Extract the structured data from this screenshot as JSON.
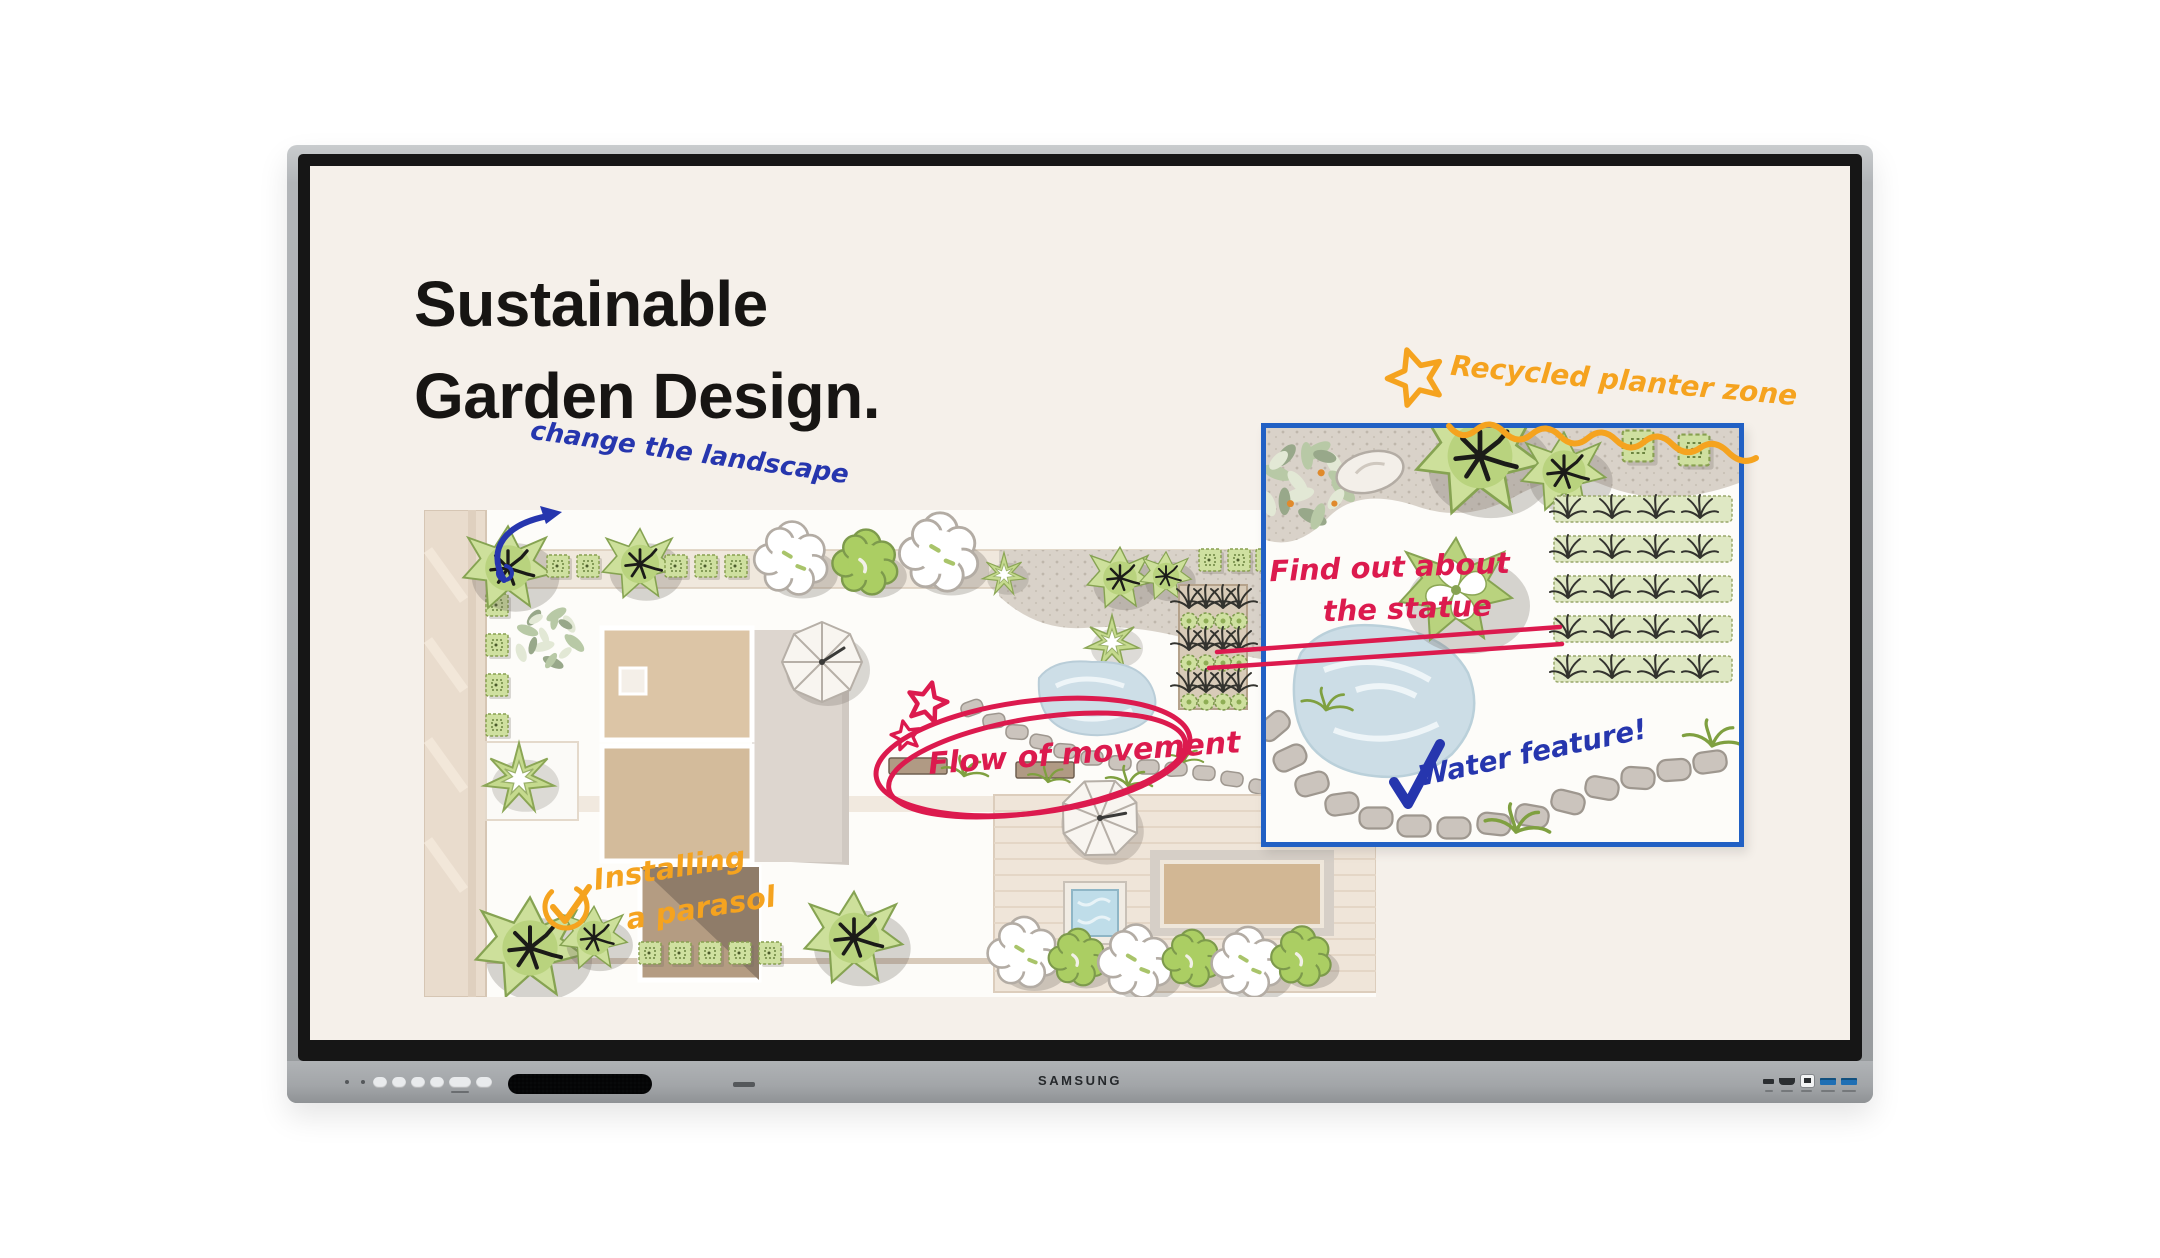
{
  "device": {
    "brand": "SAMSUNG",
    "bezel_color": "#a6a9ac",
    "controls": {
      "button_count": 6,
      "items": [
        "power-button",
        "home-button",
        "back-button",
        "volume-down-button",
        "volume-up-button",
        "source-button"
      ]
    },
    "ports": [
      "usb-c-port",
      "hdmi-port",
      "usb-b-touch-port",
      "usb3-port-1",
      "usb3-port-2"
    ]
  },
  "screen": {
    "background": "#f5f0ea",
    "title": {
      "line1": "Sustainable",
      "line2": "Garden Design."
    }
  },
  "annotations": {
    "change_landscape": {
      "text": "change the landscape",
      "color": "#2636ae"
    },
    "recycled_zone": {
      "text": "Recycled planter zone",
      "color": "#f5a31f"
    },
    "find_out": {
      "line1": "Find out about",
      "line2": "the statue",
      "color": "#dc1a4e"
    },
    "flow": {
      "text": "Flow of movement",
      "color": "#dc1a4e"
    },
    "water_feature": {
      "text": "Water feature!",
      "color": "#2636ae"
    },
    "installing": {
      "line1": "Installing",
      "line2": "a parasol",
      "color": "#f5a31f"
    }
  },
  "inset": {
    "border_color": "#2160c4",
    "description": "magnified pond detail view"
  },
  "icons": {
    "star_icon": "★",
    "check_icon": "✓",
    "circled_check_icon": "✓ in circle",
    "arrow_icon": "↗",
    "highlight_ellipse_icon": "⬭",
    "wavy_underline_icon": "〰"
  },
  "ink_colors": {
    "blue": "#2636ae",
    "red": "#dc1a4e",
    "orange": "#f5a31f"
  }
}
